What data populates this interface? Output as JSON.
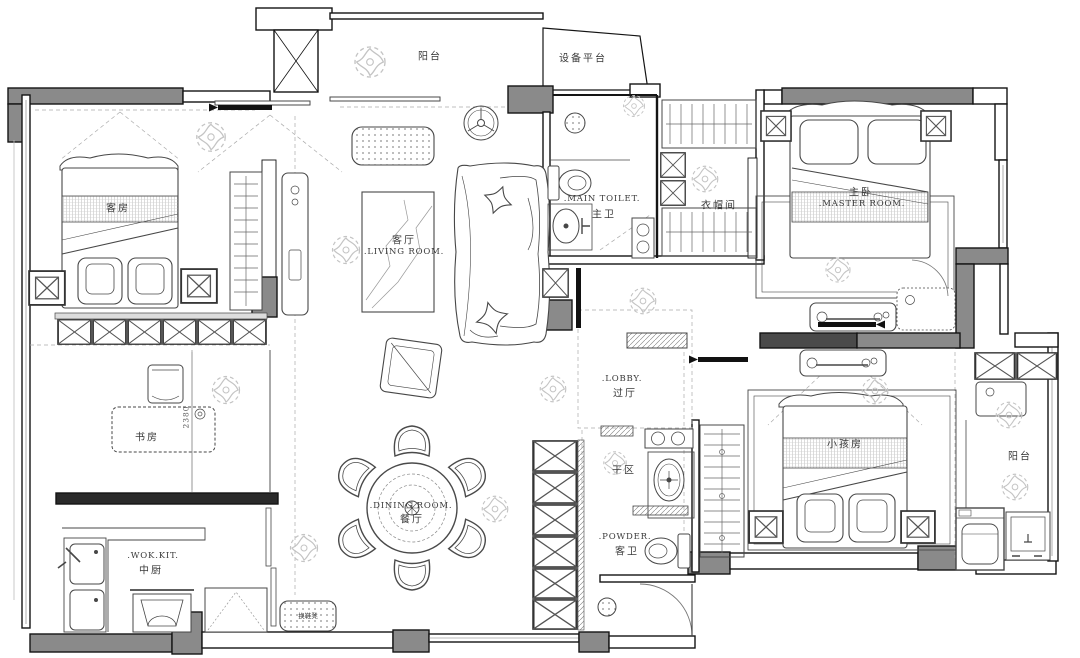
{
  "title": "apartment-floor-plan",
  "rooms": {
    "balcony_top": {
      "zh": "阳台"
    },
    "equipment": {
      "zh": "设备平台"
    },
    "guest": {
      "zh": "客房"
    },
    "living": {
      "zh": "客厅",
      "en": ".LIVING  ROOM."
    },
    "main_toilet": {
      "zh": "主卫",
      "en": ".MAIN  TOILET."
    },
    "cloakroom": {
      "zh": "衣帽间"
    },
    "master": {
      "zh": "主卧",
      "en": ".MASTER  ROOM."
    },
    "lobby": {
      "zh": "过厅",
      "en": ".LOBBY."
    },
    "study": {
      "zh": "书房"
    },
    "wok_kitchen": {
      "zh": "中厨",
      "en": ".WOK.KIT."
    },
    "dining": {
      "zh": "餐厅",
      "en": ".DINING  ROOM."
    },
    "dry_area": {
      "zh": "干区"
    },
    "powder": {
      "zh": "客卫",
      "en": ".POWDER."
    },
    "kids": {
      "zh": "小孩房"
    },
    "balcony_right": {
      "zh": "阳台"
    }
  },
  "annotations": {
    "dim_study": "2380",
    "bench": "换鞋凳"
  },
  "fixtures": [
    "bed",
    "sofa",
    "ceiling-fan",
    "dining-table",
    "dining-chair",
    "desk",
    "wardrobe",
    "toilet",
    "wash-basin",
    "shower-drain",
    "washing-machine",
    "stove",
    "fridge",
    "kitchen-sink",
    "tv-console",
    "rug",
    "ottoman",
    "doormat",
    "plant"
  ],
  "colors": {
    "wall": "#141414",
    "column_gray": "#8a8a8a",
    "furniture_line": "#474747",
    "sketch": "#c4c4c4",
    "background": "#ffffff"
  }
}
